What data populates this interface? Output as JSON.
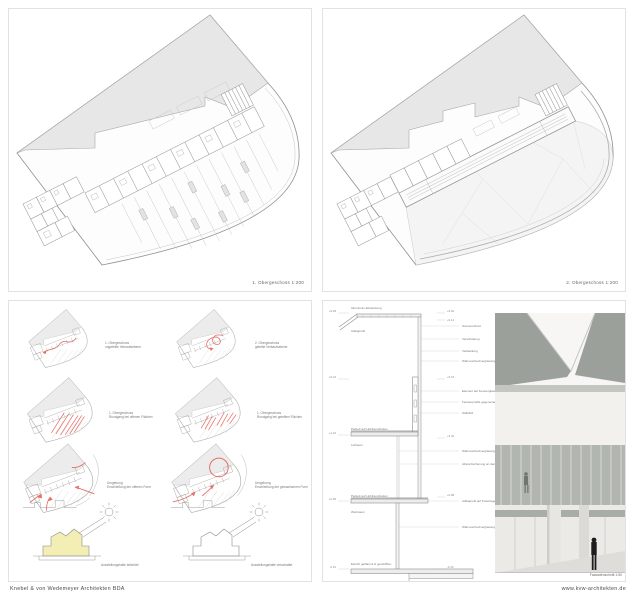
{
  "footer": {
    "left": "Knebel & von Wedemeyer Architekten BDA",
    "right": "www.kvw-architekten.de"
  },
  "plan1": {
    "caption": "1. Obergeschoss 1:200"
  },
  "plan2": {
    "caption": "2. Obergeschoss 1:200"
  },
  "diagrams": {
    "items": [
      {
        "line1": "1. Obergeschoss",
        "line2": "ungeteilte Verkaufsebene"
      },
      {
        "line1": "2. Obergeschoss",
        "line2": "geteilte Verkaufsebene"
      },
      {
        "line1": "1. Obergeschoss",
        "line2": "Rundgang bei offenen Flächen"
      },
      {
        "line1": "1. Obergeschoss",
        "line2": "Rundgang bei geteilten Flächen"
      },
      {
        "line1": "Umgebung",
        "line2": "Erschließung der offenen Form"
      },
      {
        "line1": "Umgebung",
        "line2": "Erschließung der gewachsenen Form"
      },
      {
        "line1": "Ausstellungshalle belichtet",
        "line2": ""
      },
      {
        "line1": "Ausstellungshalle verschattet",
        "line2": ""
      }
    ]
  },
  "section": {
    "caption": "Fassadenschnitt 1:50",
    "left_labels": [
      "Aluminium-Eindeckung",
      "Attikaprofil",
      "Parkett auf Hohlraumboden",
      "Luftraum",
      "Parkett auf Hohlraumboden",
      "Werkraum",
      "Estrich geflämmt & geschliffen"
    ],
    "right_labels": [
      "Sonnenschutz",
      "Verschattung",
      "Verkleidung",
      "Wärmeschutzverglasung transparent",
      "Element auf Festverglasung",
      "Fensterprofile gegeneinander & geschossweise versetzt",
      "Stahlfuß",
      "Wärmeschutzverglasung transparent",
      "Absturzsicherung an den Wandelementen",
      "Attikaprofil auf Futterlage",
      "Wärmeschutzverglasung transparent"
    ],
    "levels_left": [
      "+9.48",
      "+5.16",
      "+4.22",
      "+0.95",
      "-0.16"
    ],
    "levels_right": [
      "+9.62",
      "+9.14",
      "+5.16",
      "+3.42",
      "+0.98",
      "-0.16"
    ]
  },
  "colors": {
    "plan_gray": "#e7e7e7",
    "roof_gray": "#f4f4f4",
    "red": "#e2574c",
    "sun_yellow": "#f3eeb4",
    "render_panel": "#9ba09a",
    "render_glass": "#b2b6b0",
    "figure_dark": "#1d1d1d"
  }
}
